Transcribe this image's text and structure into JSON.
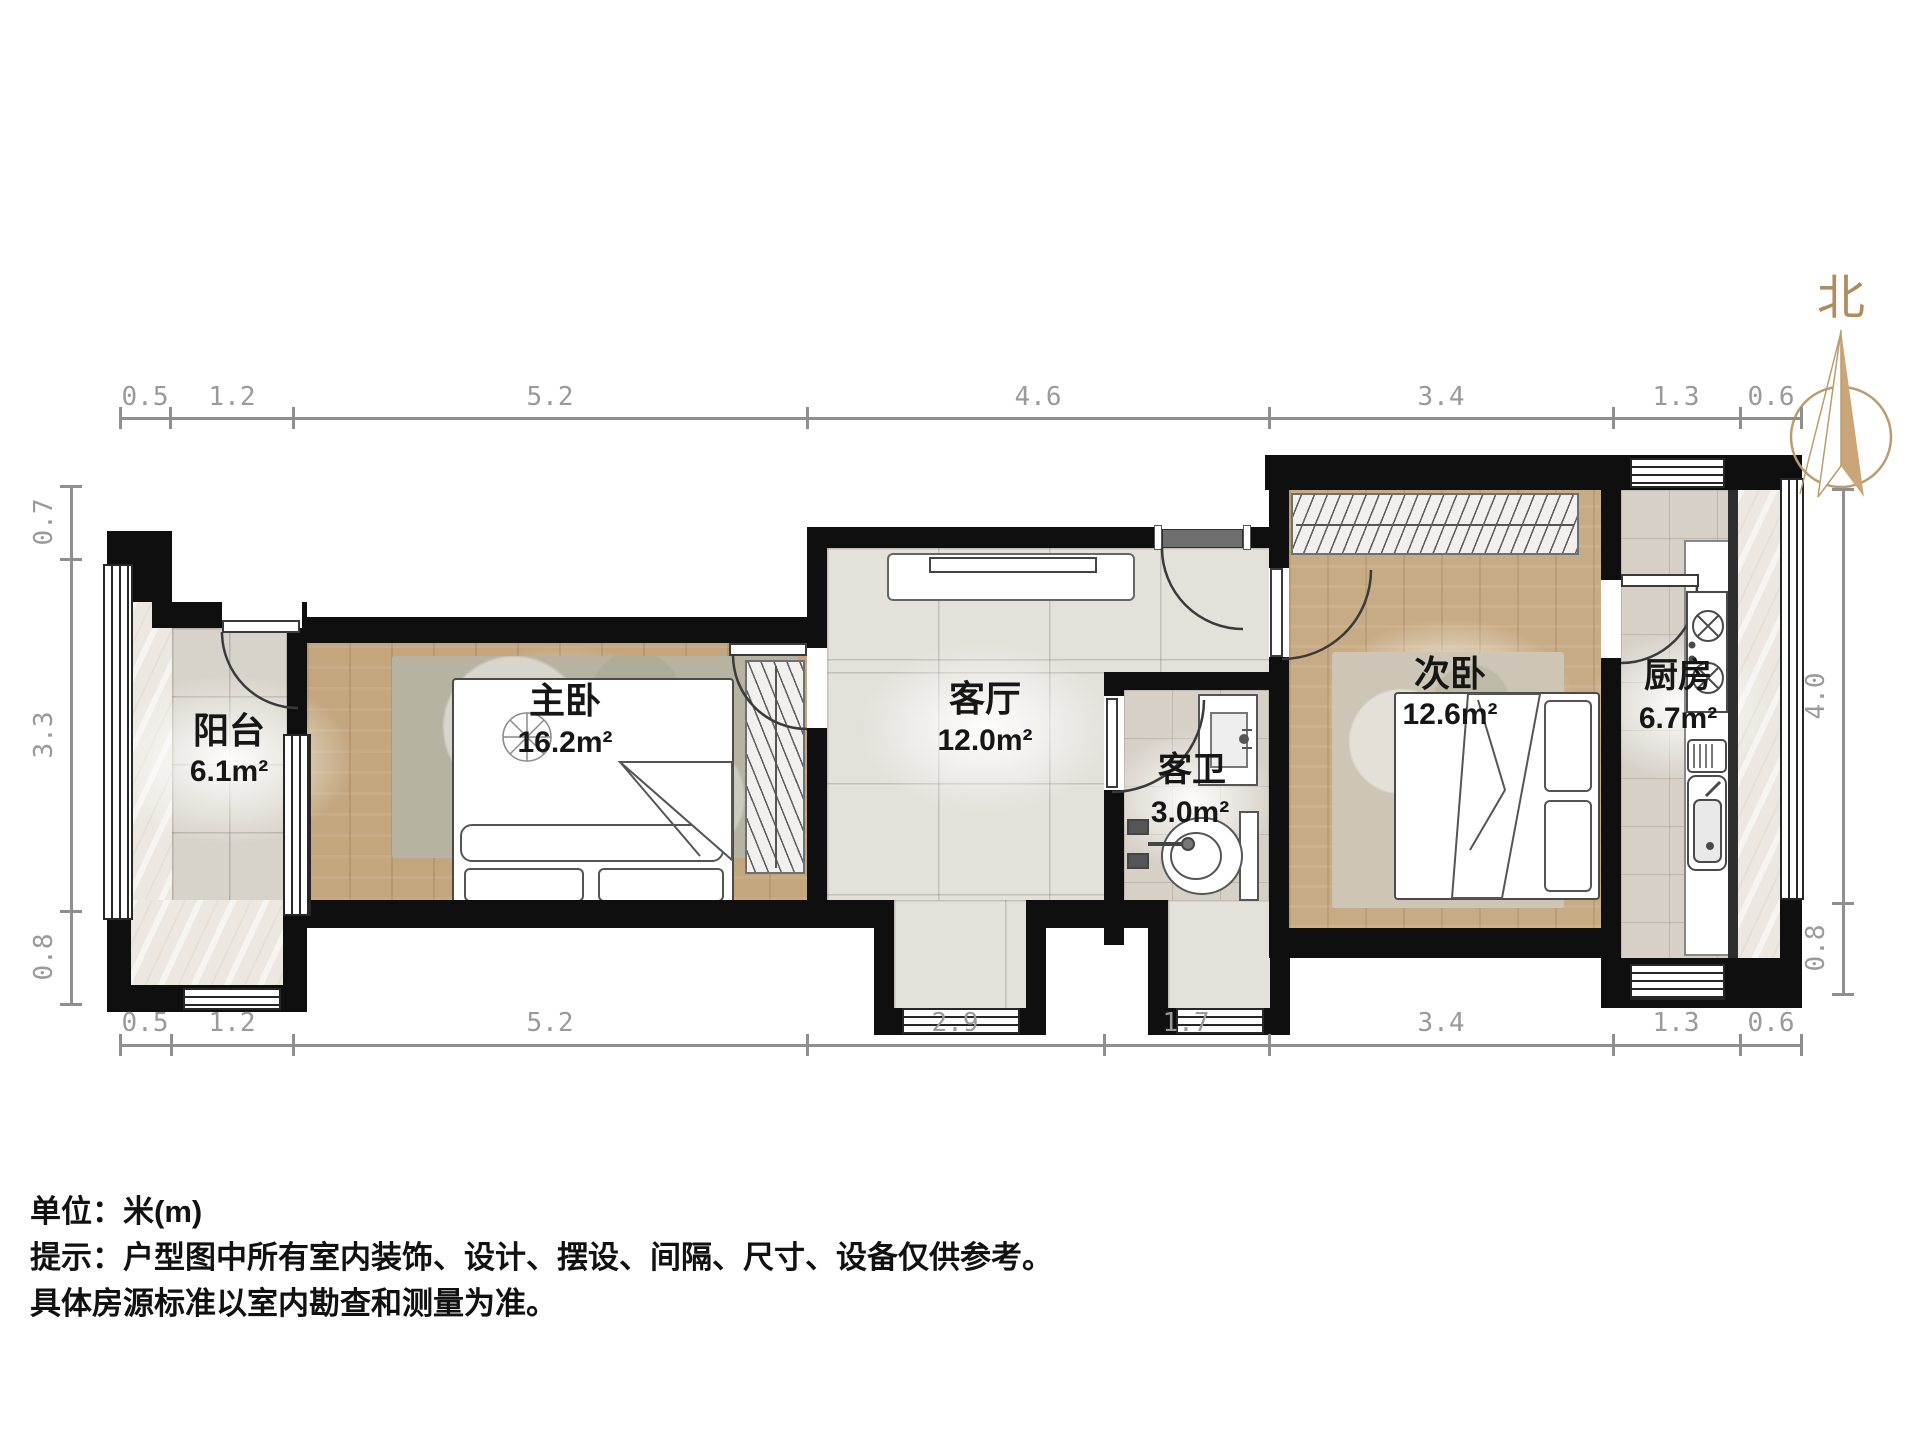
{
  "title": "户型图",
  "compass": {
    "label": "北"
  },
  "rooms": [
    {
      "id": "balcony",
      "name": "阳台",
      "area": "6.1m²"
    },
    {
      "id": "master-bedroom",
      "name": "主卧",
      "area": "16.2m²"
    },
    {
      "id": "living-room",
      "name": "客厅",
      "area": "12.0m²"
    },
    {
      "id": "bathroom",
      "name": "客卫",
      "area": "3.0m²"
    },
    {
      "id": "second-bedroom",
      "name": "次卧",
      "area": "12.6m²"
    },
    {
      "id": "kitchen",
      "name": "厨房",
      "area": "6.7m²"
    }
  ],
  "dimensions": {
    "top": [
      "0.5",
      "1.2",
      "5.2",
      "4.6",
      "3.4",
      "1.3",
      "0.6"
    ],
    "bottom": [
      "0.5",
      "1.2",
      "5.2",
      "2.9",
      "1.7",
      "3.4",
      "1.3",
      "0.6"
    ],
    "left": [
      "0.7",
      "3.3",
      "0.8"
    ],
    "right": [
      "4.0",
      "0.8"
    ]
  },
  "notes": {
    "unit": "单位：米(m)",
    "tip1": "提示：户型图中所有室内装饰、设计、摆设、间隔、尺寸、设备仅供参考。",
    "tip2": "具体房源标准以室内勘查和测量为准。"
  },
  "colors": {
    "wall": "#0f0f0f",
    "wood": "#c3a67e",
    "tile": "#e4e1db",
    "dim": "#9a9a9a",
    "north": "#b08c60"
  }
}
